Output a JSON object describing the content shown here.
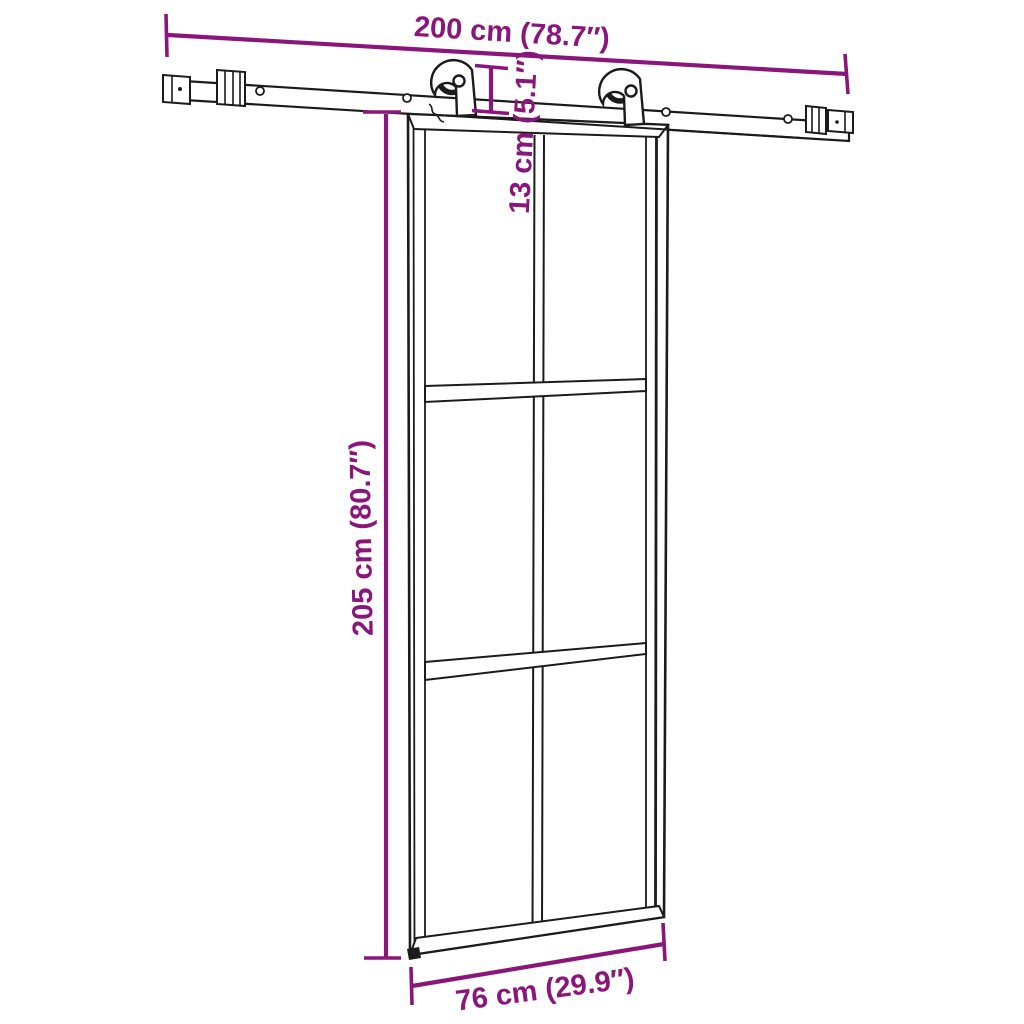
{
  "diagram": {
    "colors": {
      "accent": "#8a167c",
      "line": "#1b1b1b",
      "background": "#ffffff"
    },
    "dimensions": {
      "track_length": "200 cm (78.7″)",
      "hanger_drop": "13 cm (5.1″)",
      "door_height": "205 cm (80.7″)",
      "door_width": "76 cm (29.9″)"
    }
  }
}
